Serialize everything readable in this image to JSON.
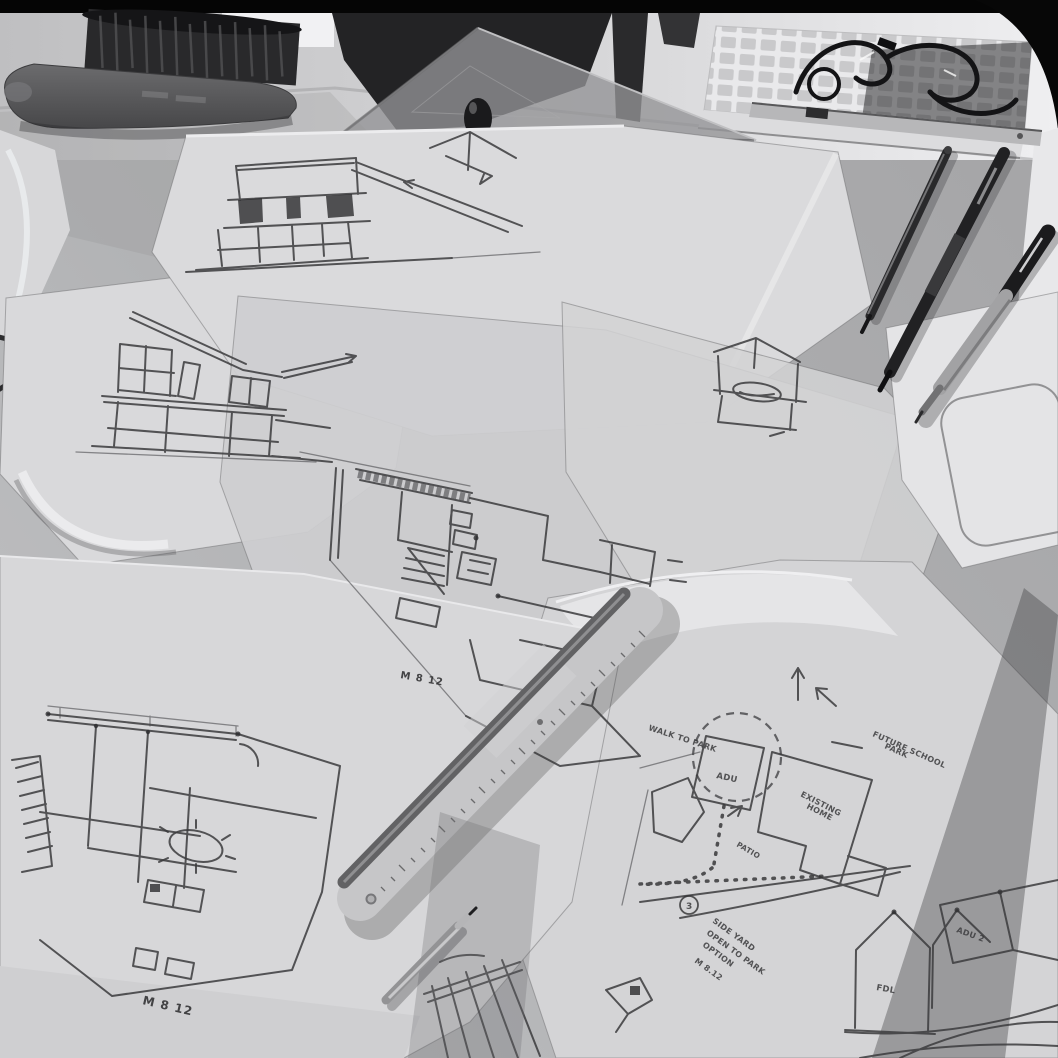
{
  "meta": {
    "description": "Black-and-white photograph of an architect's drafting desk covered with overlapping tracing-paper sheets of hand-drawn house elevations, floor plans and a neighborhood site plan, with a dusting brush, a clear set square, a computer keyboard, pens, a marker, a pencil and an aluminium scale ruler"
  },
  "scene": {
    "colors": {
      "background_black": "#070707",
      "desk": "#b3b4b6",
      "paper": "#dcdcde",
      "trace_paper": "#cfcfd1",
      "pencil_line": "#3b3b3d",
      "dark_object": "#222224",
      "aluminum_ruler": "#c6c6c8",
      "shadow": "#565658"
    }
  },
  "objects": {
    "brush": "dusting-brush",
    "set_square": "clear-set-square",
    "straightedge": "straightedge",
    "keyboard": "computer-keyboard",
    "cables": "tangled-cables",
    "pen_1": "ballpoint-pen",
    "pen_2": "ballpoint-pen",
    "marker": "sharpie-marker",
    "pencil": "pencil",
    "ruler": "aluminium-scale-ruler",
    "sheets": "tracing-paper-sketches"
  },
  "annotations": {
    "date_center_plan": "M 8 12",
    "date_bottom_plan": "M 8 12",
    "walk_to_park": "WALK TO PARK",
    "future_school_line1": "FUTURE SCHOOL",
    "future_school_line2": "PARK",
    "existing_home_line1": "EXISTING",
    "existing_home_line2": "HOME",
    "adu": "ADU",
    "patio": "PATIO",
    "step_number": "3",
    "note_line1": "SIDE YARD",
    "note_line2": "OPEN TO PARK",
    "note_line3": "OPTION",
    "note_line4": "M 8.12",
    "house_label_fdl": "FDL",
    "house_label_adu2": "ADU 2"
  }
}
